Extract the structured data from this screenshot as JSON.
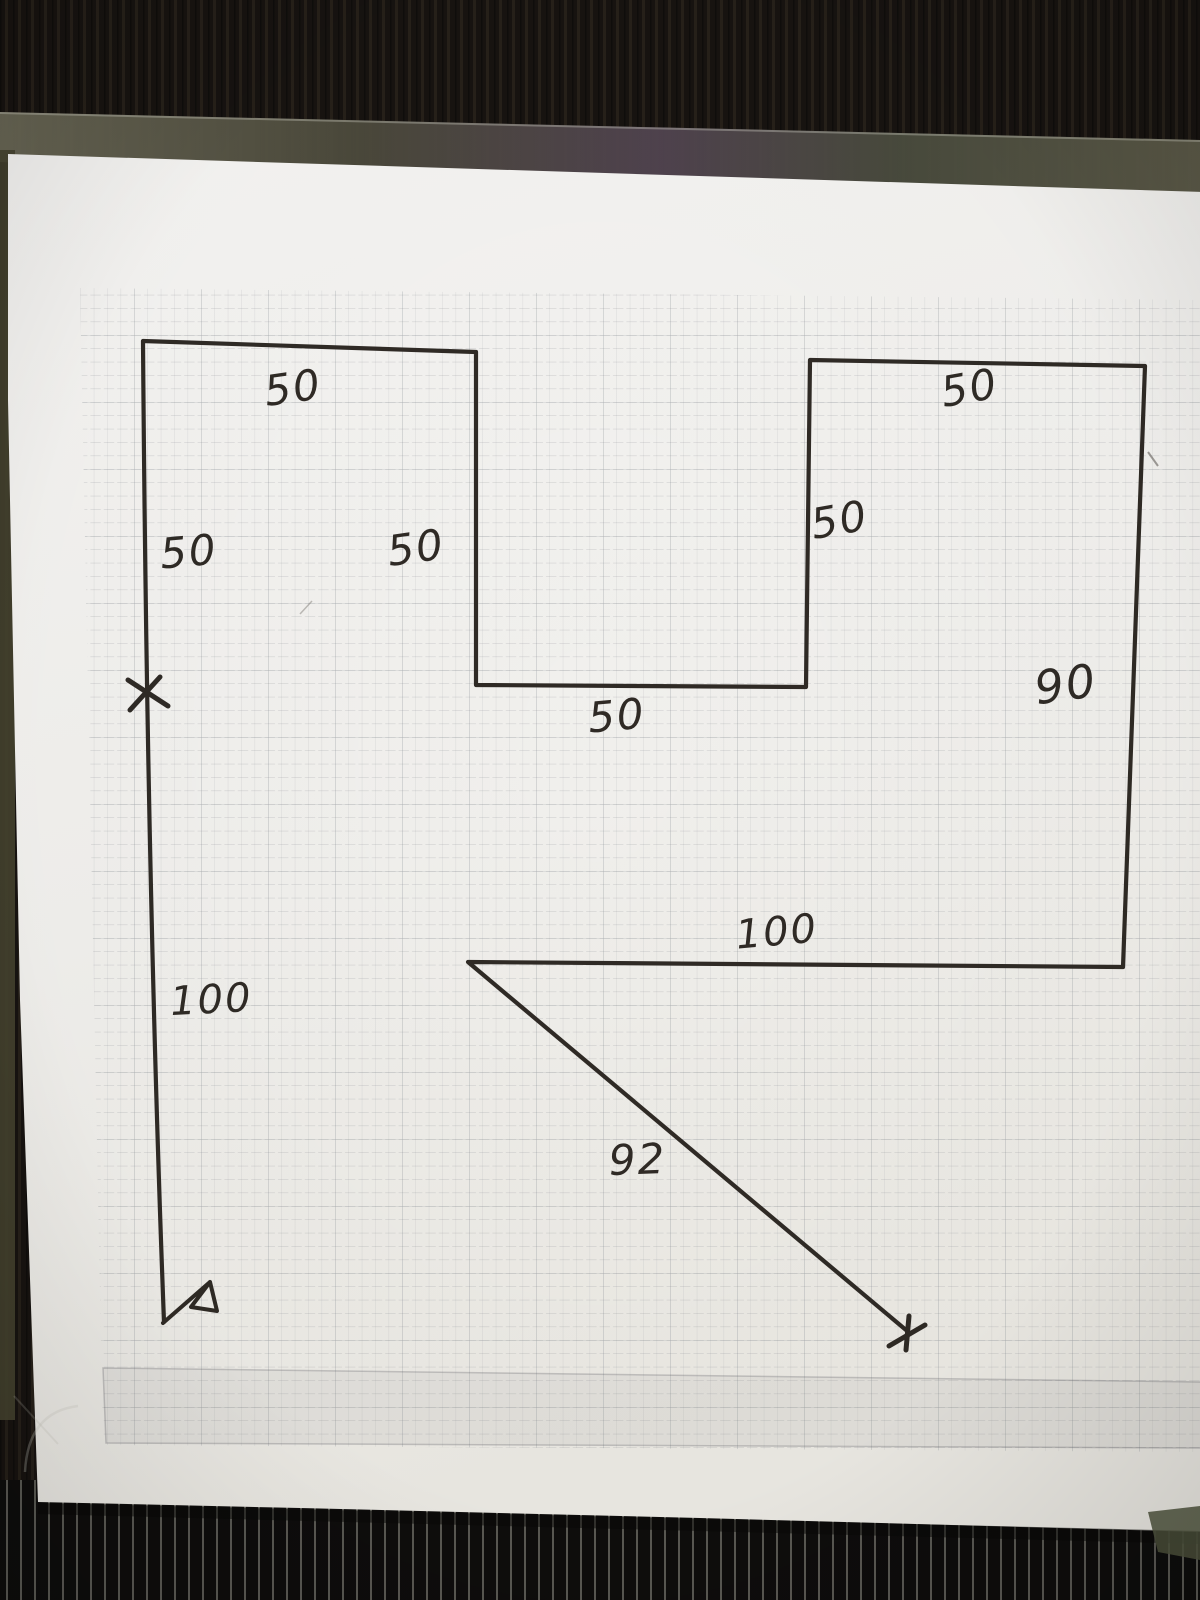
{
  "photo": {
    "colors": {
      "fabric_background": "#171310",
      "fabric_stripe": "#c9c7bc",
      "plastic_sleeve": "#55533f",
      "paper": "#f2f1ee",
      "grid_line": "#8e949c",
      "ink": "#2f2a25"
    }
  },
  "diagram": {
    "outline_path": "M164 1322 Q147 880 143 341 L476 352 L476 685 L806 687 L810 360 L1145 366 L1123 967 L468 962 L906 1330",
    "pennant_path": "M163 1323 L210 1282 L191 1307 L217 1311 L210 1282",
    "x_marks": {
      "left_a": "128,680 168,706",
      "left_b": "160,677 130,710",
      "end_a": "909,1316 906,1350",
      "end_b": "889,1346 925,1325"
    },
    "labels": [
      {
        "text": "50"
      },
      {
        "text": "50"
      },
      {
        "text": "50"
      },
      {
        "text": "50"
      },
      {
        "text": "50"
      },
      {
        "text": "50"
      },
      {
        "text": "90"
      },
      {
        "text": "100"
      },
      {
        "text": "100"
      },
      {
        "text": "92"
      }
    ]
  }
}
